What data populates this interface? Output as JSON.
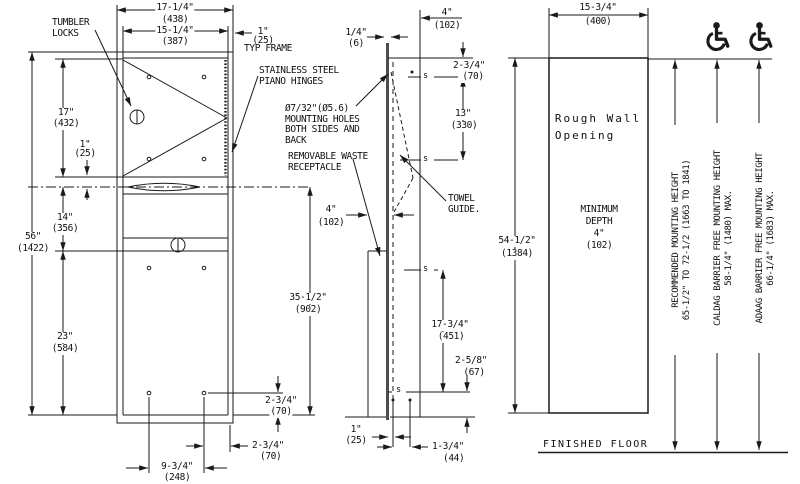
{
  "front": {
    "callouts": {
      "tumbler_locks": [
        "TUMBLER",
        "LOCKS"
      ],
      "piano_hinges": [
        "STAINLESS STEEL",
        "PIANO HINGES"
      ],
      "mounting_holes": [
        "Ø7/32\"(Ø5.6)",
        "MOUNTING HOLES",
        "BOTH SIDES AND",
        "BACK"
      ],
      "removable_waste": [
        "REMOVABLE WASTE",
        "RECEPTACLE"
      ]
    },
    "dims": {
      "width_outer": {
        "in": "17-1/4\"",
        "mm": "(438)"
      },
      "width_inner": {
        "in": "15-1/4\"",
        "mm": "(387)"
      },
      "typ_frame": {
        "in": "1\"",
        "mm": "(25)",
        "note": "TYP FRAME"
      },
      "door_height": {
        "in": "17\"",
        "mm": "(432)"
      },
      "slot_offset": {
        "in": "1\"",
        "mm": "(25)"
      },
      "mid_height": {
        "in": "14\"",
        "mm": "(356)"
      },
      "total_height": {
        "in": "56\"",
        "mm": "(1422)"
      },
      "lower_height": {
        "in": "23\"",
        "mm": "(584)"
      },
      "slot_to_bottom": {
        "in": "35-1/2\"",
        "mm": "(902)"
      },
      "hole_bottom_offset": {
        "in": "2-3/4\"",
        "mm": "(70)"
      },
      "hole_side_offset": {
        "in": "2-3/4\"",
        "mm": "(70)"
      },
      "hole_spacing": {
        "in": "9-3/4\"",
        "mm": "(248)"
      }
    }
  },
  "section": {
    "callouts": {
      "towel_guide": [
        "TOWEL",
        "GUIDE."
      ]
    },
    "s_marker": "s",
    "dims": {
      "trim": {
        "in": "1/4\"",
        "mm": "(6)"
      },
      "depth_top": {
        "in": "4\"",
        "mm": "(102)"
      },
      "top_hole": {
        "in": "2-3/4\"",
        "mm": "(70)"
      },
      "hole_span_upper": {
        "in": "13\"",
        "mm": "(330)"
      },
      "depth_mid": {
        "in": "4\"",
        "mm": "(102)"
      },
      "hole_span_lower": {
        "in": "17-3/4\"",
        "mm": "(451)"
      },
      "bottom_hole": {
        "in": "2-5/8\"",
        "mm": "(67)"
      },
      "back_gap": {
        "in": "1\"",
        "mm": "(25)"
      },
      "front_gap": {
        "in": "1-3/4\"",
        "mm": "(44)"
      }
    }
  },
  "wall_opening": {
    "label": [
      "Rough Wall",
      "Opening"
    ],
    "min_depth": [
      "MINIMUM",
      "DEPTH",
      "4\"",
      "(102)"
    ],
    "dims": {
      "width": {
        "in": "15-3/4\"",
        "mm": "(400)"
      },
      "height": {
        "in": "54-1/2\"",
        "mm": "(1384)"
      }
    },
    "finished_floor": "FINISHED FLOOR"
  },
  "mounting_heights": {
    "recommended": {
      "label": "RECOMMENDED MOUNTING HEIGHT",
      "value": "65-1/2\" TO 72-1/2 (1663 TO 1841)"
    },
    "caldag": {
      "label": "CALDAG BARRIER FREE MOUNTING HEIGHT",
      "value": "58-1/4\" (1480) MAX."
    },
    "adaag": {
      "label": "ADAAG BARRIER FREE MOUNTING HEIGHT",
      "value": "66-1/4\" (1683) MAX."
    }
  }
}
